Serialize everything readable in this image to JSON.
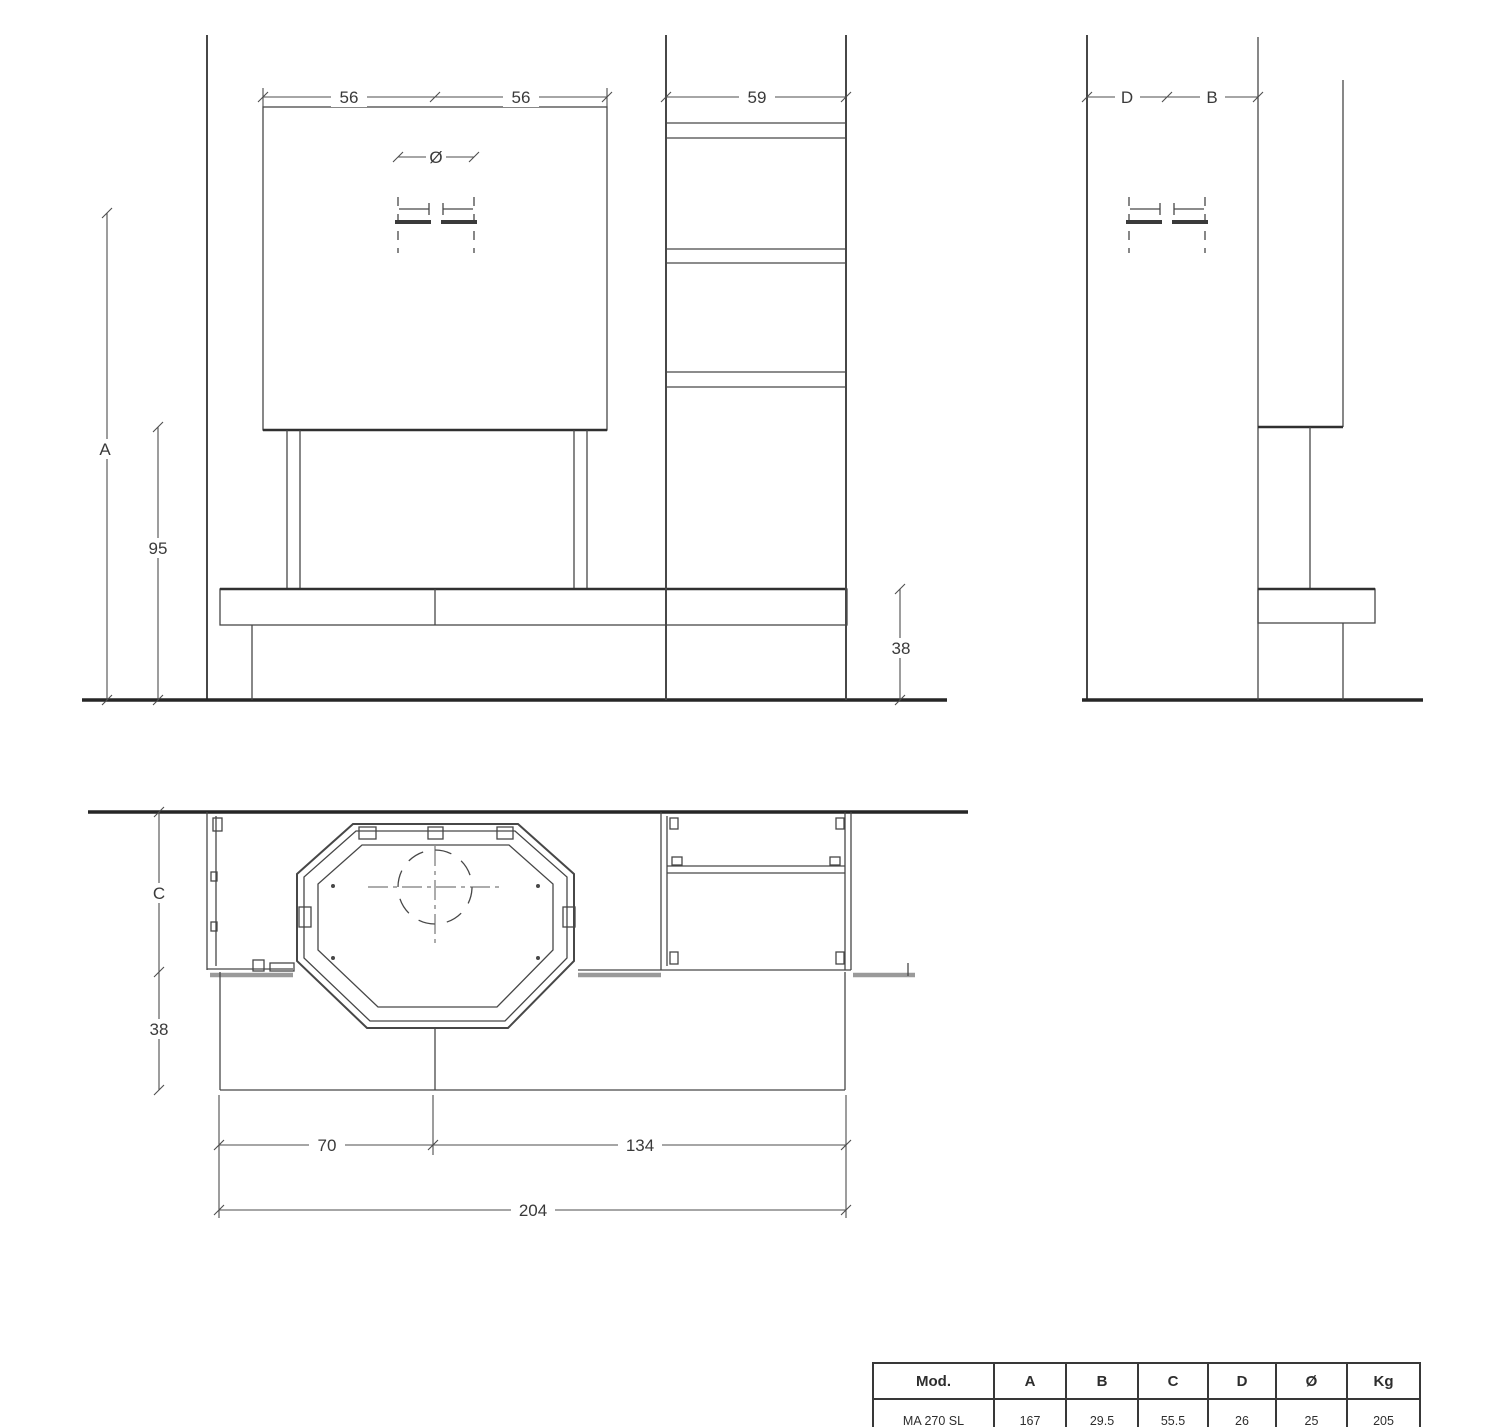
{
  "colors": {
    "line": "#474747",
    "line_heavy": "#262626",
    "hatch_gray": "#9a9a9a",
    "text": "#3a3a3a",
    "background": "#ffffff"
  },
  "front_view": {
    "dim_left_half": "56",
    "dim_right_half": "56",
    "dim_column_width": "59",
    "dim_flue_diameter": "Ø",
    "dim_total_height": "A",
    "dim_firebox_height": "95",
    "dim_hearth_height": "38"
  },
  "side_view": {
    "dim_rear_depth": "D",
    "dim_front_depth": "B"
  },
  "plan_view": {
    "dim_body_depth": "C",
    "dim_hearth_depth": "38",
    "dim_firebox_width": "70",
    "dim_right_section_width": "134",
    "dim_total_width": "204"
  },
  "spec_table": {
    "headers": [
      "Mod.",
      "A",
      "B",
      "C",
      "D",
      "Ø",
      "Kg"
    ],
    "row": [
      "MA 270 SL",
      "167",
      "29.5",
      "55.5",
      "26",
      "25",
      "205"
    ]
  }
}
